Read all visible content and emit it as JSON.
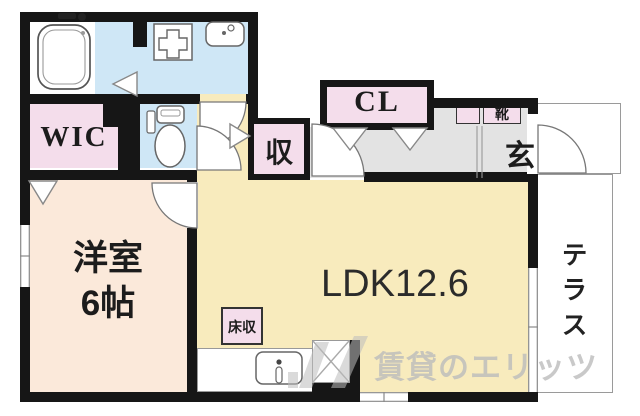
{
  "title": "apartment floor plan",
  "rooms": {
    "wic": {
      "label": "WIC"
    },
    "cl": {
      "label": "CL"
    },
    "storage": {
      "label": "収"
    },
    "shoes": {
      "label": "靴"
    },
    "entrance": {
      "label": "玄"
    },
    "western": {
      "name": "洋室",
      "size": "6帖"
    },
    "ldk": {
      "label": "LDK12.6"
    },
    "floor_storage": {
      "label": "床収"
    },
    "terrace": {
      "label": "テラス"
    }
  },
  "fixtures": [
    "bathtub-icon",
    "washing-machine-pan-icon",
    "washbasin-icon",
    "toilet-icon",
    "kitchen-sink-icon",
    "refrigerator-space-icon"
  ],
  "watermark": {
    "text": "賃貸のエリッツ",
    "color": "#bcbcbc"
  },
  "colors": {
    "wall": "#161616",
    "wet-area-blue": "#cfe7f6",
    "closet-pink": "#f4ddeb",
    "bedroom-peach": "#fbe9da",
    "ldk-yellow": "#f8ebbd",
    "hall-gray": "#e3e3e3"
  }
}
